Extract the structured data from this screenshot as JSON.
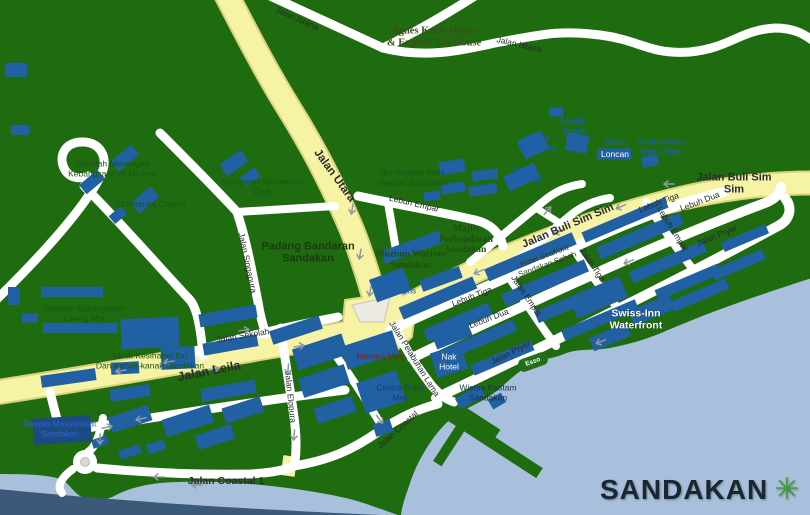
{
  "logo": {
    "text": "SANDAKAN",
    "flower_icon": "green-flower",
    "text_color": "#1b2730",
    "flower_color": "#3f9a2f"
  },
  "colors": {
    "land": "#1f6b10",
    "water": "#a8c0db",
    "water_deep": "#3d5979",
    "road_major": "#f7f3a4",
    "road_minor": "#ffffff",
    "building": "#2160a2",
    "label_green": "#175710",
    "label_blue": "#1a5fc0",
    "label_navy": "#14406e",
    "label_red": "#7d2418"
  },
  "road_labels": {
    "jalan_istana_nw": "Jalan Istana",
    "jalan_istana_ne": "Jalan Istana",
    "jalan_utara": "Jalan Utara",
    "jalan_buli_sim_sim_mid": "Jalan Buli Sim Sim",
    "jalan_buli_sim_sim_east": "Jalan Buli Sim Sim",
    "lebuh_empar": "Lebuh Empar",
    "lebuh_tiga_west": "Lebuh Tiga",
    "lebuh_tiga_east": "Lebuh Tiga",
    "lebuh_dua_west": "Lebuh Dua",
    "lebuh_dua_east": "Lebuh Dua",
    "lebuh_empat": "Lebuh Empat",
    "jalan_empat": "Jalan Empat",
    "jalan_tiga": "Jalan Tiga",
    "jalan_pryer_east": "Jalan Pryer",
    "jalan_pryer_south": "Jalan Pryer",
    "jalan_leila": "Jalan Leila",
    "jalan_sekolah": "Jalan Sekolah",
    "jalan_singapura": "Jalan Singapura",
    "jalan_elopura": "Jalan Elopura",
    "jalan_pelabuhan_lama": "Jalan Pelabuhan Lama",
    "jalan_coastal": "Jalan Coastal",
    "jalan_coastal_1": "Jalan Coastal 1"
  },
  "place_labels": {
    "agnes_keith_house": "Agnes Keith House\n& English Tea House",
    "masjid_jamek": "Masjid\nJamek",
    "wisma_sandakan": "Wisma\nSandakan",
    "hotel_loncan_name": "Hotel",
    "hotel_loncan_building": "Loncan",
    "wisma_khoo_siak_chiew": "Wisma Khoo\nSiak Chiew",
    "hotel_sandakan": "Hotel\nSandakan",
    "ibu_pejabat_polis": "Ibu Pejabat Polis\nDaerah Sandakan",
    "majlis_perbandaran": "Majlis\nPerbandaran\nSandakan",
    "muzium_warisan": "Muzium Warisan\nSandakan",
    "wisma_harrisons": "Wisma\nHarrisons",
    "hotel_seafront": "Hotel Seafront\nSandakan Sabah",
    "padang_bandaran": "Padang Bandaran\nSandakan",
    "sekolah_menengah_st_michael": "Sekolah Menengah\nKebangsaan St Michael",
    "st_michael_church": "St Michael Church",
    "sandakan_recreation_club": "Sandakan Recreation\nClub",
    "sekolah_kebangsaan_cheng_min": "Sekolah Kebangsaan\nCheng Min",
    "klinik_kesihatan": "Klinik Kesihatan Ibu\nDan Kanak-kanak Sandakan",
    "dewan_masyarakat": "Dewan Masyarakat\nSandakan",
    "swiss_inn_waterfront": "Swiss-Inn\nWaterfront",
    "menara_mps": "Menara Mps",
    "centre_point_mall": "Centre Point\nMall",
    "nak_hotel": "Nak\nHotel",
    "wisma_kastam": "Wisma Kastam\nSandakan",
    "esso": "Esso"
  }
}
